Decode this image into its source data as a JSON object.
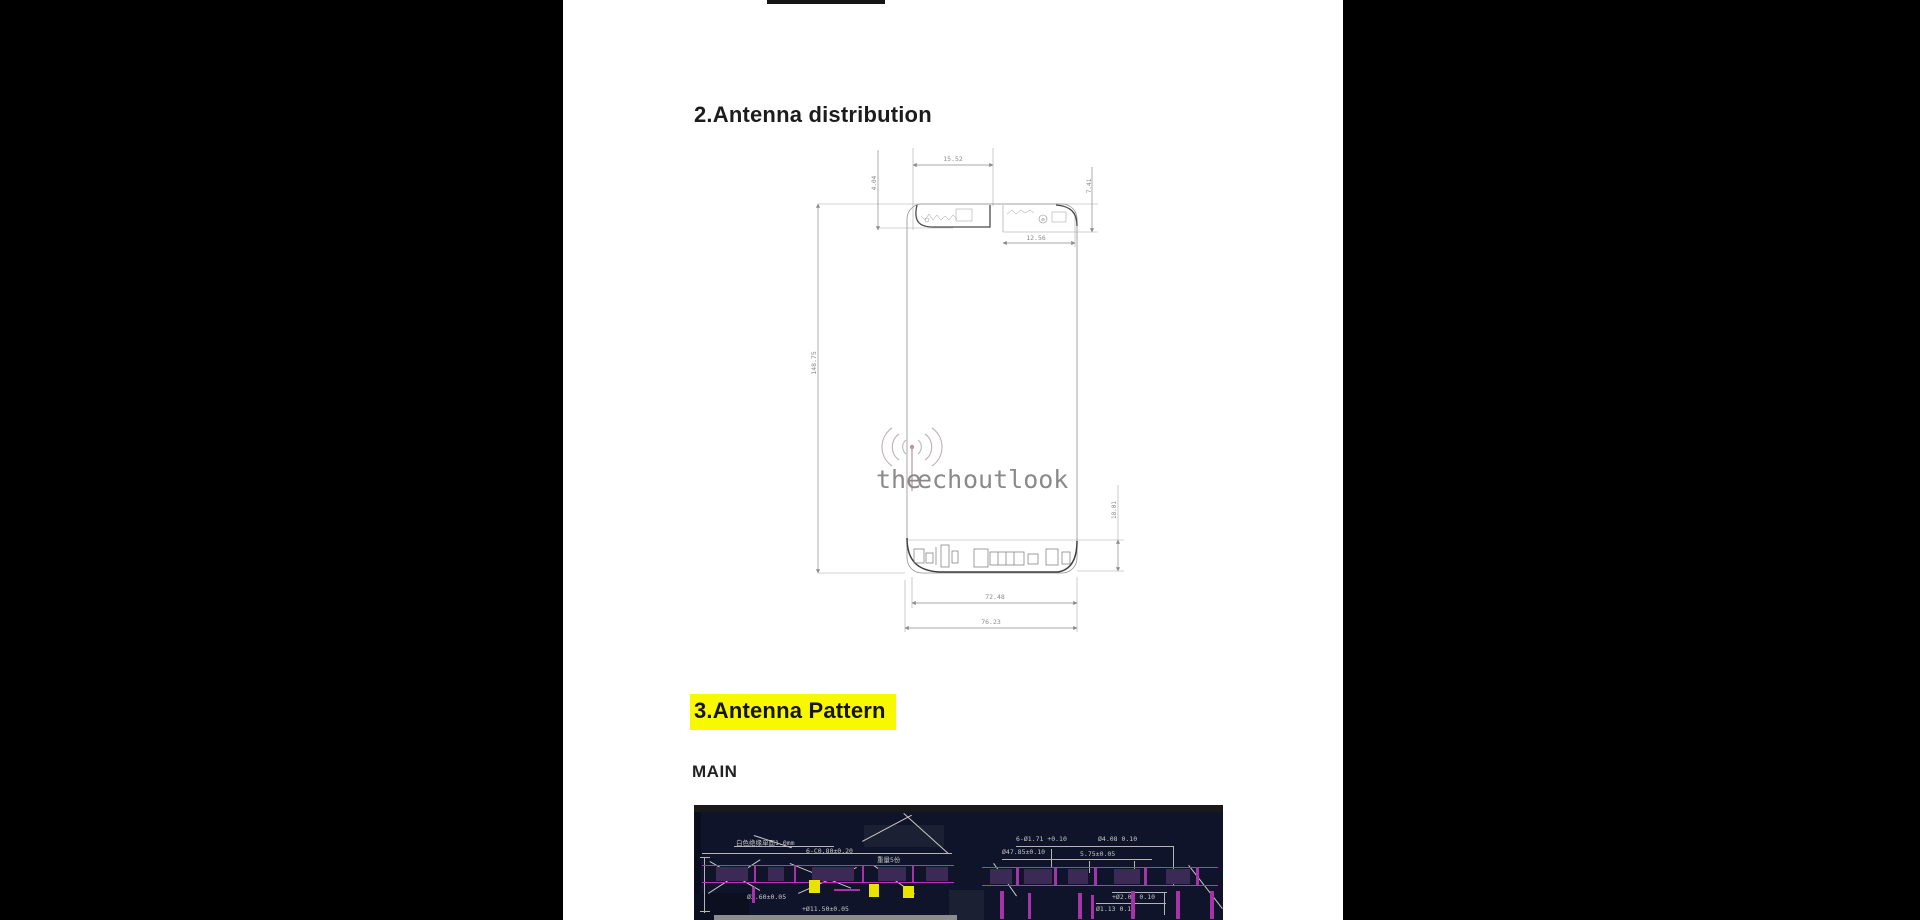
{
  "document": {
    "section2_title": "2.Antenna distribution",
    "section3_title": "3.Antenna Pattern",
    "section3_subsection": "MAIN",
    "highlight_color": "#f8f800"
  },
  "diagram": {
    "dims": {
      "top_cap_width": "15.52",
      "top_left_height": "4.04",
      "top_right_height": "7.41",
      "top_right_width": "12.56",
      "body_height": "148.75",
      "bottom_cap_height": "18.01",
      "bottom_inner_width": "72.48",
      "bottom_outer_width": "76.23"
    },
    "cap_symbol": "⊖"
  },
  "watermark": {
    "part1": "the",
    "part2": "ech",
    "part3": "outlook",
    "color_strong": "#e2abb0",
    "color_light": "#efc9cc"
  },
  "cad": {
    "colors": {
      "background": "#10142a",
      "magenta": "#c22ec2",
      "purple": "#3c2a56",
      "yellow": "#e8e400",
      "annotation": "#c6c6c6"
    },
    "labels": {
      "left1": "白色绝缘单面1.0mm",
      "left2": "6-C0.80±0.20",
      "left3": "重量5份",
      "left4": "Ø2.60±0.05",
      "left5": "+Ø11.50±0.05",
      "right1": "6-Ø1.71 +0.10",
      "right2": "Ø4.08 0.10",
      "right3": "Ø47.85±0.10",
      "right4": "5.75±0.05",
      "right5": "+Ø2.08 0.10",
      "right6": "Ø1.13 0.10"
    }
  }
}
